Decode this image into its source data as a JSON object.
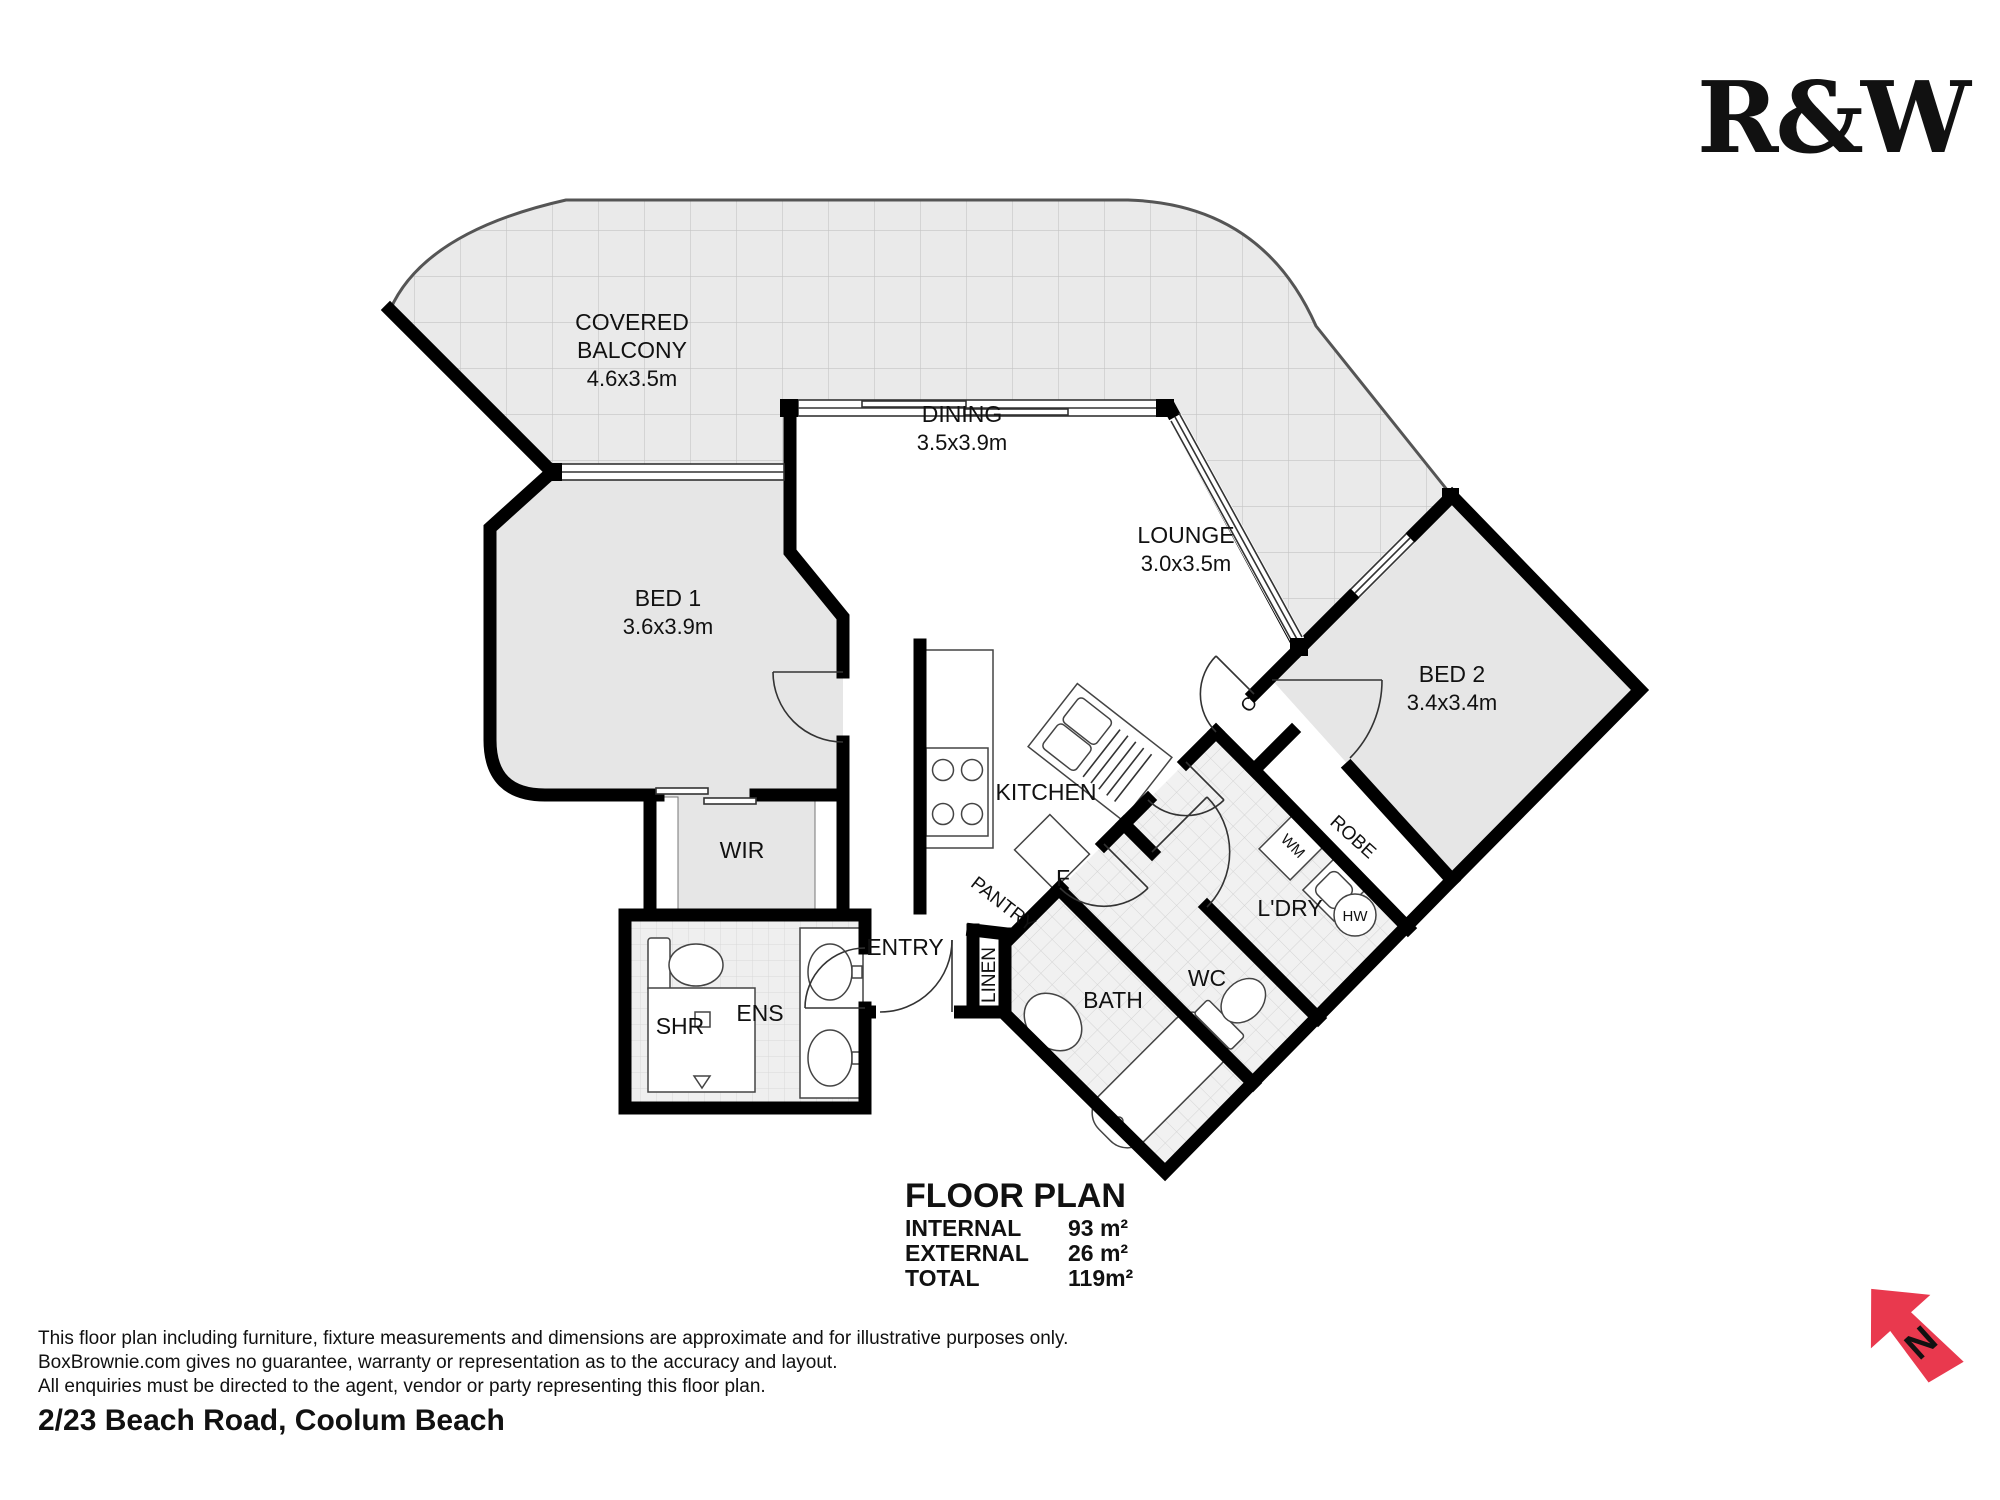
{
  "brand": {
    "logo": "R&W",
    "red": "#DC2B44"
  },
  "compass": {
    "n": "N",
    "red": "#E9394E"
  },
  "colors": {
    "wall": "#000000",
    "room_gray": "#E6E6E6",
    "balcony_tile": "#EAEAEA",
    "wet_tile": "#F1F1F1"
  },
  "rooms": {
    "balcony": {
      "line1": "COVERED",
      "line2": "BALCONY",
      "dims": "4.6x3.5m"
    },
    "dining": {
      "name": "DINING",
      "dims": "3.5x3.9m"
    },
    "lounge": {
      "name": "LOUNGE",
      "dims": "3.0x3.5m"
    },
    "bed1": {
      "name": "BED 1",
      "dims": "3.6x3.9m"
    },
    "bed2": {
      "name": "BED 2",
      "dims": "3.4x3.4m"
    },
    "wir": {
      "name": "WIR"
    },
    "kitchen": {
      "name": "KITCHEN"
    },
    "pantry": {
      "name": "PANTRY"
    },
    "fridge": {
      "label": "F"
    },
    "entry": {
      "name": "ENTRY"
    },
    "linen": {
      "name": "LINEN"
    },
    "bath": {
      "name": "BATH"
    },
    "wc": {
      "name": "WC"
    },
    "laundry": {
      "name": "L'DRY"
    },
    "wm": {
      "label": "WM"
    },
    "hw": {
      "label": "HW"
    },
    "robe": {
      "name": "ROBE"
    },
    "closet": {
      "label": "C"
    },
    "shower": {
      "name": "SHR"
    },
    "ensuite": {
      "name": "ENS"
    }
  },
  "summary": {
    "title": "FLOOR PLAN",
    "internal_label": "INTERNAL",
    "internal_value": "93 m²",
    "external_label": "EXTERNAL",
    "external_value": "26 m²",
    "total_label": "TOTAL",
    "total_value": "119m²"
  },
  "disclaimer": {
    "line1": "This floor plan including furniture, fixture measurements and dimensions are approximate and for illustrative purposes only.",
    "line2": "BoxBrownie.com gives no guarantee, warranty or representation as to the accuracy and layout.",
    "line3": "All enquiries must be directed to the agent, vendor or party representing this floor plan."
  },
  "address": "2/23 Beach Road, Coolum Beach"
}
